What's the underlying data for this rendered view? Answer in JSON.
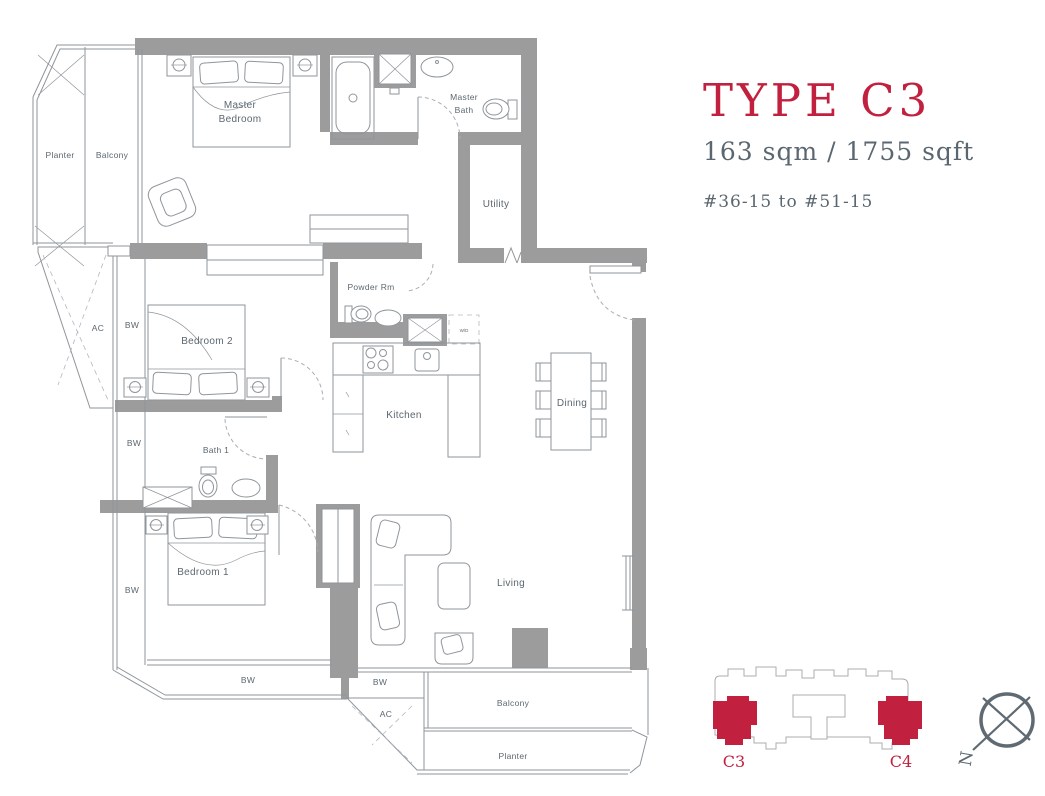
{
  "colors": {
    "accent": "#c2203f",
    "wall": "#9c9c9c",
    "line": "#8f969b",
    "label": "#5b6770",
    "kout": "#a9adb0"
  },
  "title": {
    "type": "TYPE C3",
    "area": "163 sqm / 1755 sqft",
    "units": "#36-15 to #51-15"
  },
  "plan": {
    "rooms": {
      "planter": "Planter",
      "balcony": "Balcony",
      "master_line1": "Master",
      "master_line2": "Bedroom",
      "master_bath_line1": "Master",
      "master_bath_line2": "Bath",
      "utility": "Utility",
      "powder_room": "Powder Rm",
      "bedroom2": "Bedroom 2",
      "bath1": "Bath 1",
      "kitchen": "Kitchen",
      "dining": "Dining",
      "bedroom1": "Bedroom 1",
      "living": "Living"
    },
    "annotations": {
      "ac": "AC",
      "bw": "BW",
      "wd": "W/D"
    }
  },
  "keyplan": {
    "unit_left": "C3",
    "unit_right": "C4"
  },
  "compass": {
    "north": "N"
  }
}
